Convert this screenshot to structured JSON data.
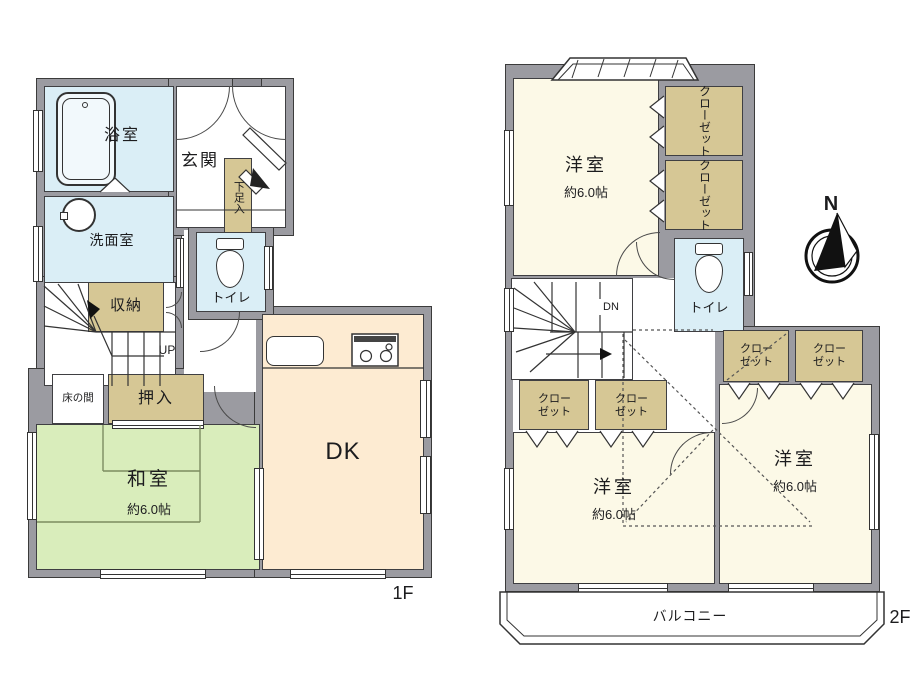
{
  "floor1": {
    "floor_label": "1F",
    "rooms": {
      "bath": "浴室",
      "entrance": "玄関",
      "shoe_cabinet": "下足入",
      "washroom": "洗面室",
      "toilet": "トイレ",
      "storage": "収納",
      "stairs_direction": "UP",
      "tokonoma": "床の間",
      "futon_closet": "押入",
      "japanese_room": "和室",
      "japanese_room_size": "約6.0帖",
      "dining_kitchen": "DK"
    }
  },
  "floor2": {
    "floor_label": "2F",
    "rooms": {
      "western_room_north": "洋室",
      "western_room_north_size": "約6.0帖",
      "western_room_southwest": "洋室",
      "western_room_southwest_size": "約6.0帖",
      "western_room_southeast": "洋室",
      "western_room_southeast_size": "約6.0帖",
      "closet": "クローゼット",
      "toilet": "トイレ",
      "stairs_direction": "DN",
      "balcony": "バルコニー"
    },
    "compass_north_label": "N"
  },
  "colors": {
    "wall": "#9b9ba1",
    "water_rooms": "#daeef6",
    "closet_storage": "#d6c795",
    "tatami_room": "#d9edbb",
    "dining_kitchen": "#fdebd2",
    "western_room": "#fcf9e7",
    "outline": "#3b3b3b"
  }
}
